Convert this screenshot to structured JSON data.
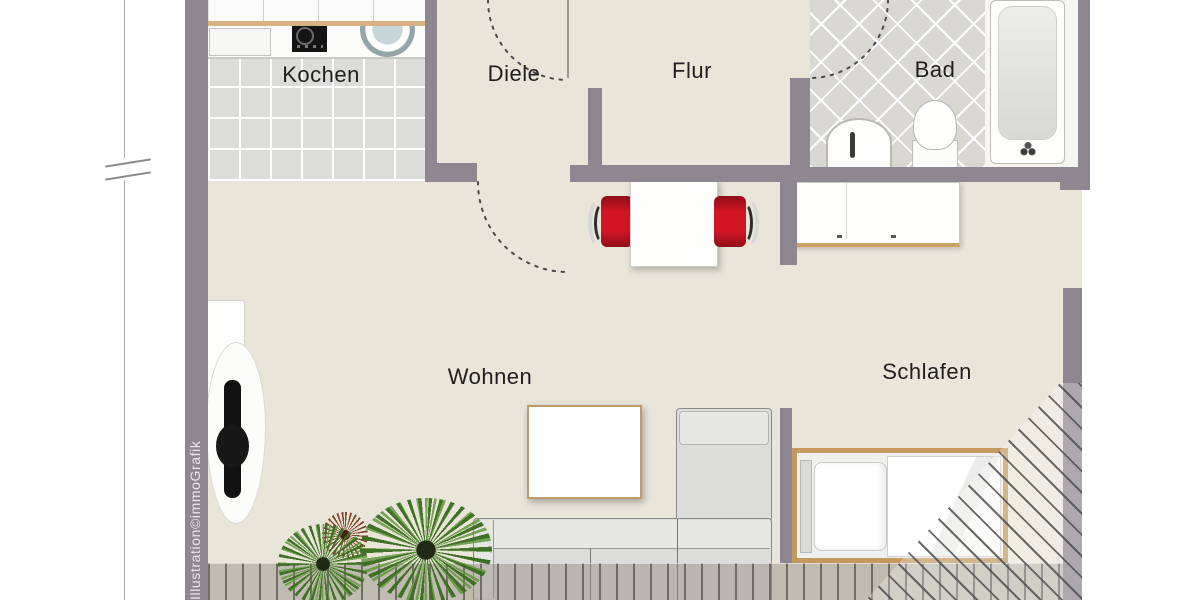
{
  "rooms": {
    "kochen": "Kochen",
    "diele": "Diele",
    "flur": "Flur",
    "bad": "Bad",
    "wohnen": "Wohnen",
    "schlafen": "Schlafen"
  },
  "watermark": "Illustration©immoGrafik",
  "colors": {
    "wall": "#8e8791",
    "floor": "#e9e5d9",
    "kitchen_tile": "#dcdcda",
    "bath_tile": "#d9d7d1",
    "chair_red": "#c41525",
    "wood": "#c7a067",
    "sofa": "#dcdcda"
  }
}
